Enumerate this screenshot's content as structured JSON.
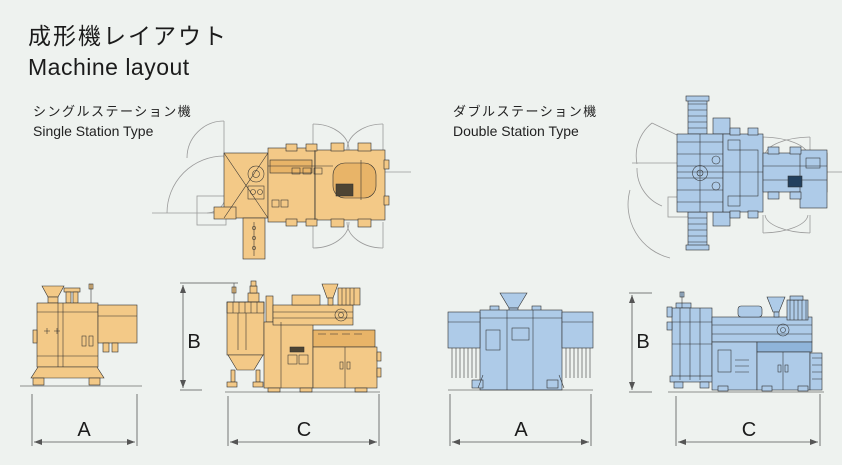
{
  "header": {
    "title_ja": "成形機レイアウト",
    "title_en": "Machine layout"
  },
  "sections": {
    "single": {
      "label_ja": "シングルステーション機",
      "label_en": "Single Station Type",
      "machine_color": "#f3c987",
      "views": [
        "top-layout-with-door-swings",
        "side-view",
        "front-view"
      ]
    },
    "double": {
      "label_ja": "ダブルステーション機",
      "label_en": "Double Station Type",
      "machine_color": "#aecbe8",
      "views": [
        "top-layout-with-door-swings",
        "side-view",
        "front-view"
      ]
    }
  },
  "dimensions": {
    "single": {
      "width_label": "A",
      "height_label": "B",
      "length_label": "C"
    },
    "double": {
      "width_label": "A",
      "height_label": "B",
      "length_label": "C"
    }
  },
  "colors": {
    "background": "#eef2ef",
    "single-fill": "#f3c987",
    "single-accent": "#e8b468",
    "double-fill": "#aecbe8",
    "double-accent": "#8fb4da",
    "line": "#2f2f2f",
    "arc": "#9a9a9a",
    "dimension": "#555555",
    "text": "#1b1b1b"
  }
}
